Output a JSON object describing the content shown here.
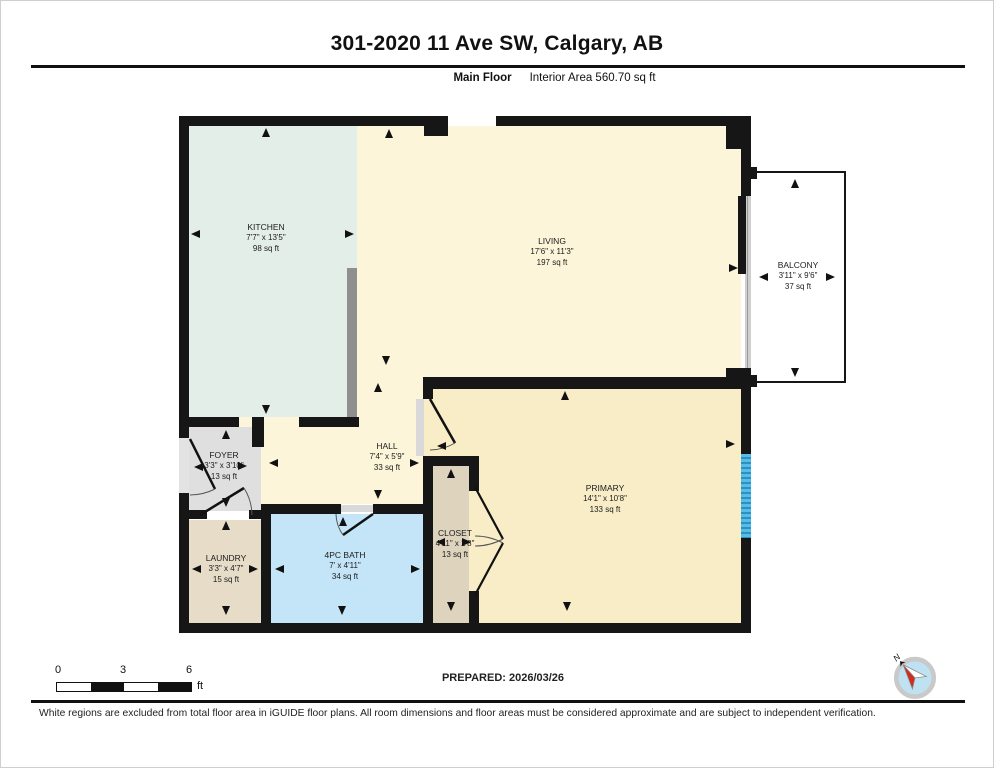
{
  "header": {
    "title": "301-2020 11 Ave SW, Calgary, AB",
    "floor_label": "Main Floor",
    "area_label": "Interior Area 560.70 sq ft"
  },
  "rooms": {
    "kitchen": {
      "name": "KITCHEN",
      "dims": "7'7\" x 13'5\"",
      "area": "98 sq ft"
    },
    "living": {
      "name": "LIVING",
      "dims": "17'6\" x 11'3\"",
      "area": "197 sq ft"
    },
    "balcony": {
      "name": "BALCONY",
      "dims": "3'11\" x 9'6\"",
      "area": "37 sq ft"
    },
    "foyer": {
      "name": "FOYER",
      "dims": "3'3\" x 3'10\"",
      "area": "13 sq ft"
    },
    "hall": {
      "name": "HALL",
      "dims": "7'4\" x 5'9\"",
      "area": "33 sq ft"
    },
    "primary": {
      "name": "PRIMARY",
      "dims": "14'1\" x 10'8\"",
      "area": "133 sq ft"
    },
    "laundry": {
      "name": "LAUNDRY",
      "dims": "3'3\" x 4'7\"",
      "area": "15 sq ft"
    },
    "bath": {
      "name": "4PC BATH",
      "dims": "7' x 4'11\"",
      "area": "34 sq ft"
    },
    "closet": {
      "name": "CLOSET",
      "dims": "4'11\" x 2'8\"",
      "area": "13 sq ft"
    }
  },
  "scale_bar": {
    "tick_0": "0",
    "tick_3": "3",
    "tick_6": "6",
    "unit": "ft"
  },
  "compass": {
    "north_label": "N"
  },
  "footer": {
    "prepared": "PREPARED: 2026/03/26",
    "disclaimer": "White regions are excluded from total floor area in iGUIDE floor plans. All room dimensions and floor areas must be considered approximate and are subject to independent verification."
  },
  "colors": {
    "wall": "#161616",
    "kitchen_fill": "#e4eee8",
    "living_fill": "#fcf5d9",
    "primary_fill": "#f8edc6",
    "bath_fill": "#c4e5f7",
    "laundry_fill": "#e6dcc8",
    "closet_fill": "#ded3bd",
    "foyer_fill": "#dfdfdf",
    "window_blue": "#55bdea"
  }
}
